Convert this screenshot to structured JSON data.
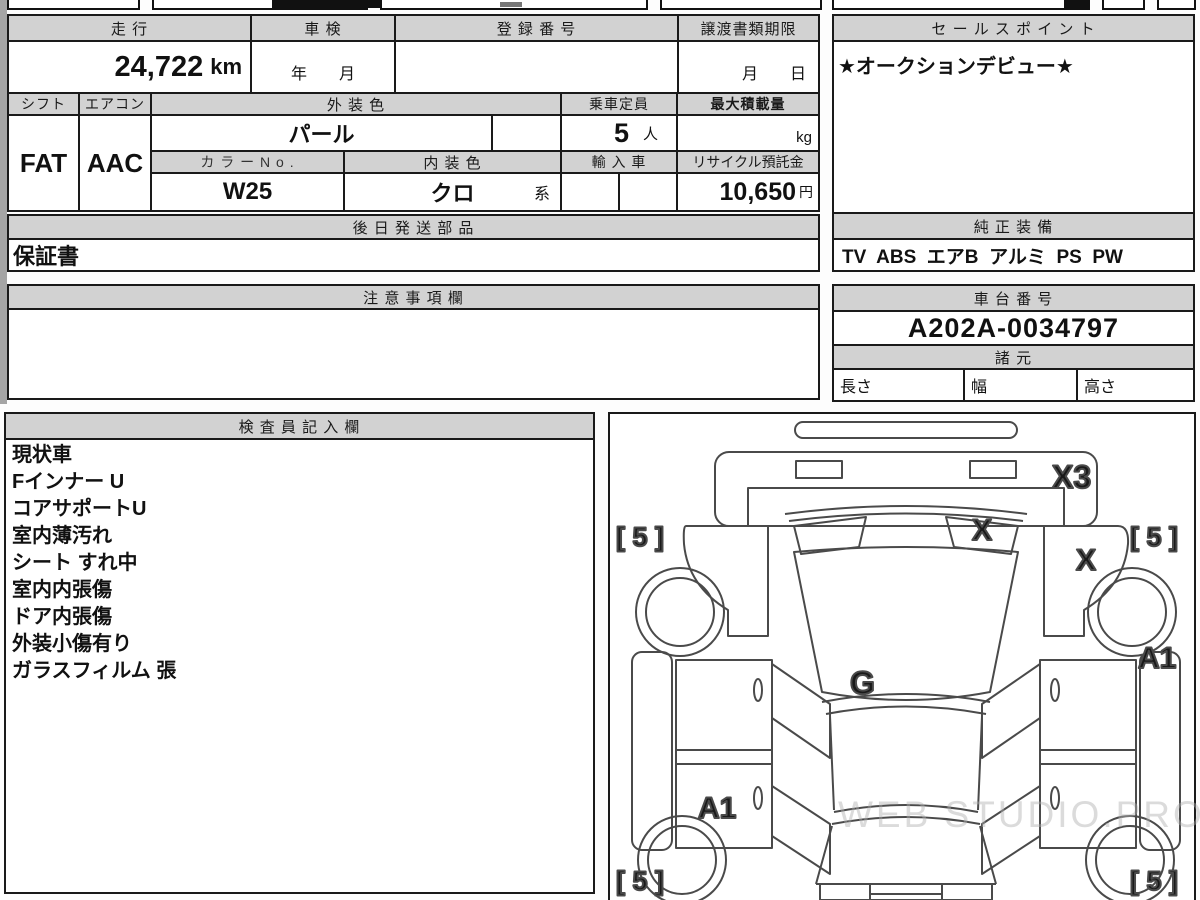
{
  "doc_type": "auction-sheet",
  "vehicle": {
    "mileage_label": "走 行",
    "mileage_value": "24,722",
    "mileage_unit": "km",
    "inspection_label": "車 検",
    "inspection_value": "年　　月",
    "registration_label": "登 録 番 号",
    "registration_value": "",
    "transfer_deadline_label": "譲渡書類期限",
    "transfer_deadline_value": "月　　日",
    "sales_point_label": "セ ー ル ス ポ イ ン ト",
    "sales_point_value": "★オークションデビュー★",
    "shift_label": "シフト",
    "shift_value": "FAT",
    "aircon_label": "エアコン",
    "aircon_value": "AAC",
    "exterior_color_label": "外 装 色",
    "exterior_color_value": "パール",
    "capacity_label": "乗車定員",
    "capacity_value": "5",
    "capacity_unit": "人",
    "max_load_label": "最大積載量",
    "max_load_unit": "kg",
    "color_no_label": "カ ラ ー N o .",
    "color_no_value": "W25",
    "interior_color_label": "内 装 色",
    "interior_color_value": "クロ",
    "interior_color_suffix": "系",
    "import_label": "輸 入 車",
    "recycle_label": "リサイクル預託金",
    "recycle_value": "10,650",
    "recycle_unit": "円",
    "later_parts_label": "後 日 発 送 部 品",
    "later_parts_value": "保証書",
    "equipment_label": "純 正 装 備",
    "equipment_value": "TV  ABS  エアB  アルミ  PS  PW",
    "notes_label": "注 意 事 項 欄",
    "notes_value": "",
    "chassis_label": "車 台 番 号",
    "chassis_value": "A202A-0034797",
    "specs_label": "諸 元",
    "spec_length_label": "長さ",
    "spec_width_label": "幅",
    "spec_height_label": "高さ"
  },
  "inspector": {
    "label": "検 査 員 記 入 欄",
    "items": [
      "現状車",
      "Fインナー U",
      "コアサポートU",
      "室内薄汚れ",
      "シート すれ中",
      "室内内張傷",
      "ドア内張傷",
      "外装小傷有り",
      "ガラスフィルム 張"
    ]
  },
  "diagram": {
    "marks": {
      "panel_top_right": "X3",
      "cowl_x": "X",
      "fender_right_x": "X",
      "center_g": "G",
      "a1_left": "A1",
      "a1_right": "A1",
      "tire_front_left": "[ 5 ]",
      "tire_front_right": "[ 5 ]",
      "tire_rear_left": "[ 5 ]",
      "tire_rear_right": "[ 5 ]"
    }
  },
  "watermark": "WEB STUDIO.PRO",
  "colors": {
    "header_bg": "#d2d2d2",
    "border": "#1a1a1a",
    "page": "#fdfdfd"
  }
}
